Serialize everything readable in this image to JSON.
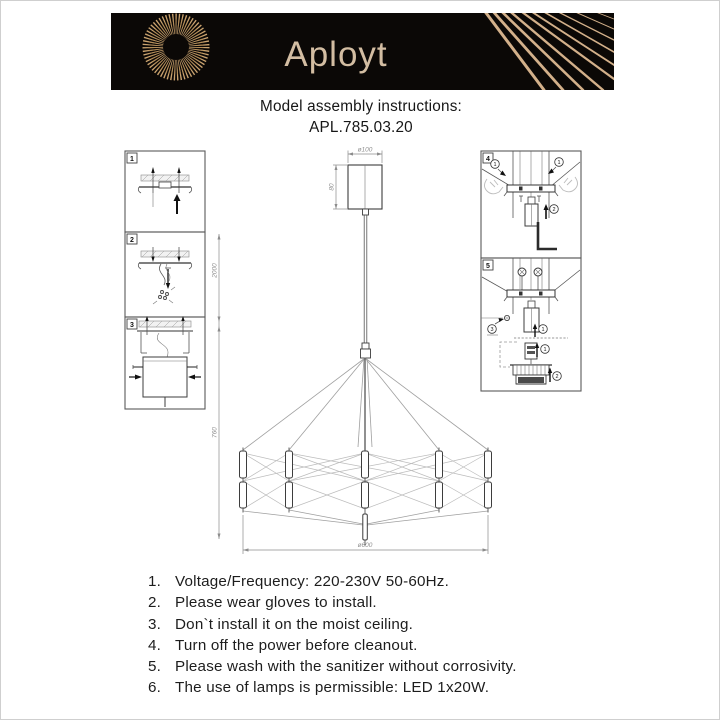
{
  "banner": {
    "brand": "Aployt",
    "bg": "#0b0806",
    "accent": "#d3b08a"
  },
  "title": {
    "line1": "Model assembly instructions:",
    "line2": "APL.785.03.20"
  },
  "diagram": {
    "steps": {
      "s1": "1",
      "s2": "2",
      "s3": "3",
      "s4": "4",
      "s5": "5"
    },
    "callouts": {
      "c1": "1",
      "c2": "2",
      "c3": "3"
    },
    "dimensions": {
      "canopy_diameter": "ø100",
      "canopy_height": "80",
      "suspension": "2000",
      "body_height": "760",
      "body_diameter": "ø600"
    }
  },
  "instructions": {
    "items": [
      {
        "n": "1.",
        "t": "Voltage/Frequency: 220-230V 50-60Hz."
      },
      {
        "n": "2.",
        "t": "Please wear gloves to install."
      },
      {
        "n": "3.",
        "t": "Don`t install it on the moist ceiling."
      },
      {
        "n": "4.",
        "t": "Turn off the power before cleanout."
      },
      {
        "n": "5.",
        "t": "Please wash with the sanitizer without corrosivity."
      },
      {
        "n": "6.",
        "t": "The use of lamps is permissible: LED 1x20W."
      }
    ]
  }
}
